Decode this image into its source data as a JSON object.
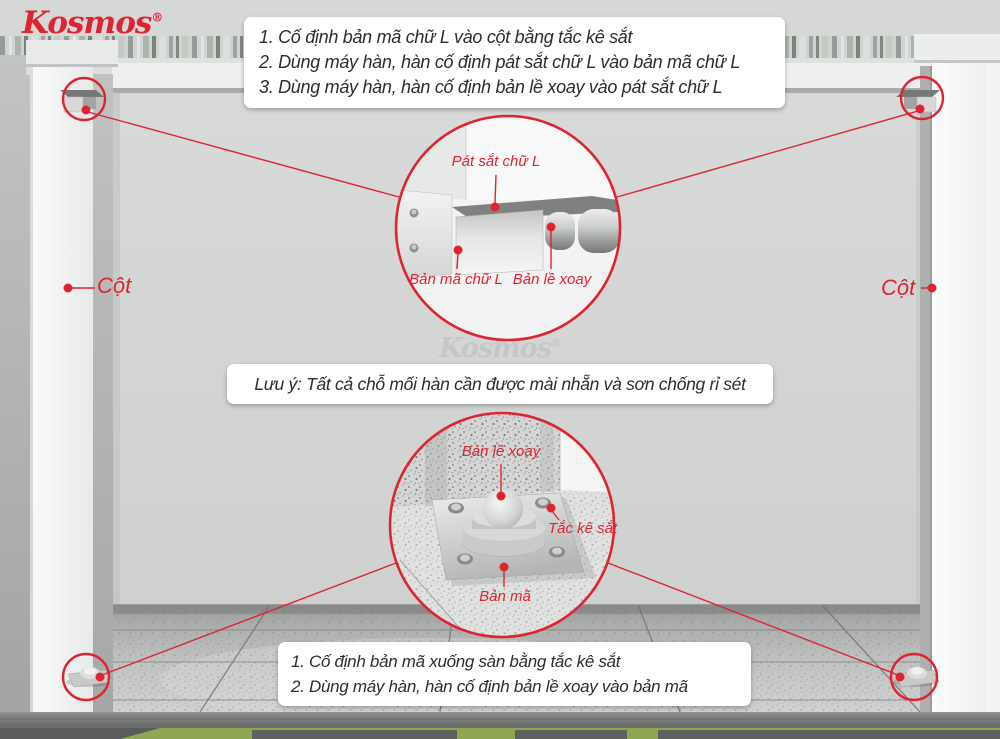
{
  "brand": {
    "name": "Kosmos",
    "registered": "®"
  },
  "watermark": {
    "text": "Kosmos",
    "registered": "®"
  },
  "instructions_top": [
    "1. Cố định bản mã chữ L vào cột bằng tắc kê sắt",
    "2. Dùng máy hàn, hàn cố định pát sắt chữ L vào bản mã chữ L",
    "3. Dùng máy hàn, hàn cố định bản lề xoay vào pát sắt chữ L"
  ],
  "note": "Lưu ý: Tất cả chỗ mối hàn cần được mài nhẵn và sơn chống rỉ sét",
  "instructions_bottom": [
    "1. Cố định bản mã xuống sàn bằng tắc kê sắt",
    "2. Dùng máy hàn, hàn cố định bản lề xoay vào bản mã"
  ],
  "scene_labels": {
    "column_left": "Cột",
    "column_right": "Cột"
  },
  "detail_top_labels": {
    "pat_sat_chu_l": "Pát sắt chữ L",
    "ban_ma_chu_l": "Bản mã chữ L",
    "ban_le_xoay": "Bản lề xoay"
  },
  "detail_bottom_labels": {
    "ban_le_xoay": "Bản lề xoay",
    "tac_ke_sat": "Tắc kê sắt",
    "ban_ma": "Bản mã"
  },
  "colors": {
    "accent_red": "#de2430",
    "text_dark": "#2d2d2d"
  }
}
